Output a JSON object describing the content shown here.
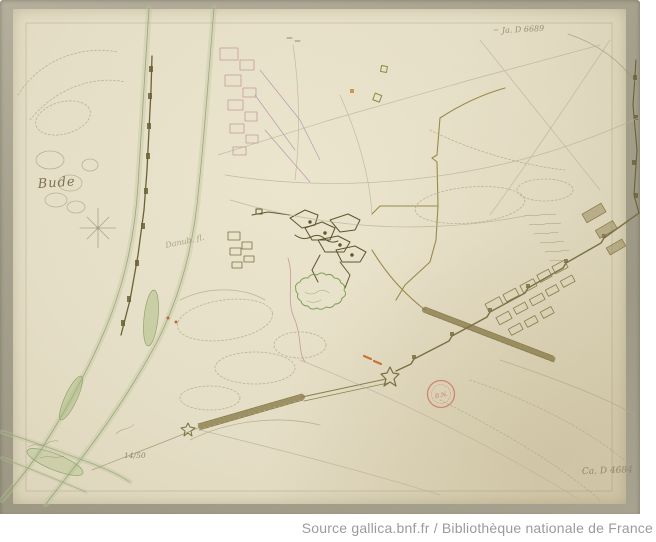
{
  "caption": {
    "text": "Source gallica.bnf.fr / Bibliothèque nationale de France",
    "color": "#9b9b9b"
  },
  "map": {
    "labels": {
      "place": "Bude",
      "river": "Danub. fl.",
      "sheet_number": "14/50",
      "shelfmark_top": "Ja. D 6689",
      "shelfmark_bottom": "Ca. D 4684",
      "stamp": "B.N."
    },
    "colors": {
      "mount": "#a5a08c",
      "paper": "#e6dfc7",
      "ink_olive": "#6b6136",
      "trench_olive": "#99894a",
      "wall_olive": "#7a6f42",
      "river_green": "#b5c697",
      "pink_ink": "#c49a9a",
      "hachure": "#b3aa8d",
      "stamp_red": "#cf7868",
      "orange_mark": "#c06a28"
    },
    "icons": [
      "compass-rose",
      "library-stamp"
    ]
  }
}
